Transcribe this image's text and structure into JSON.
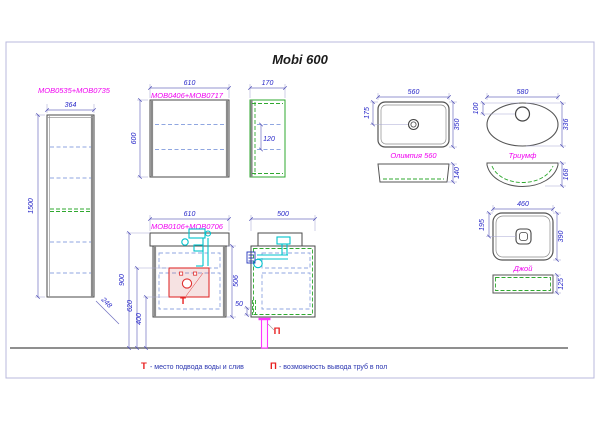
{
  "title": "Mobi 600",
  "colors": {
    "dimension_text": "#2525c8",
    "product_label": "#f000f0",
    "marker_red": "#e82020",
    "pipe_magenta": "#ff35ff",
    "accent_green": "#2fa82f",
    "accent_cyan": "#00c2cc"
  },
  "tall_cabinet": {
    "label": "MOB0535+MOB0735",
    "width": "364",
    "height": "1500",
    "depth": "248"
  },
  "wall_cabinet": {
    "label": "MOB0406+MOB0717",
    "width": "610",
    "height": "600",
    "side_depth": "170",
    "side_inner": "120"
  },
  "vanity": {
    "label": "MOB0106+MOB0706",
    "width": "610",
    "height": "506",
    "height_to_top": "900",
    "height_620": "620",
    "height_400": "400",
    "supply_marker": "Т",
    "side_depth": "500",
    "side_gap": "50",
    "floor_marker": "П"
  },
  "sinks": {
    "olimpia": {
      "name": "Олимпия 560",
      "width": "560",
      "depth": "350",
      "drain_offset": "175",
      "side_height": "140"
    },
    "triumf": {
      "name": "Триумф",
      "width": "580",
      "depth": "336",
      "drain_offset": "100",
      "side_height": "168"
    },
    "joy": {
      "name": "Джой",
      "width": "460",
      "depth": "390",
      "drain_offset": "195",
      "side_height": "125"
    }
  },
  "legend": {
    "t_symbol": "Т",
    "t_text": "- место подвода воды и слив",
    "p_symbol": "П",
    "p_text": "- возможность вывода труб в пол"
  }
}
